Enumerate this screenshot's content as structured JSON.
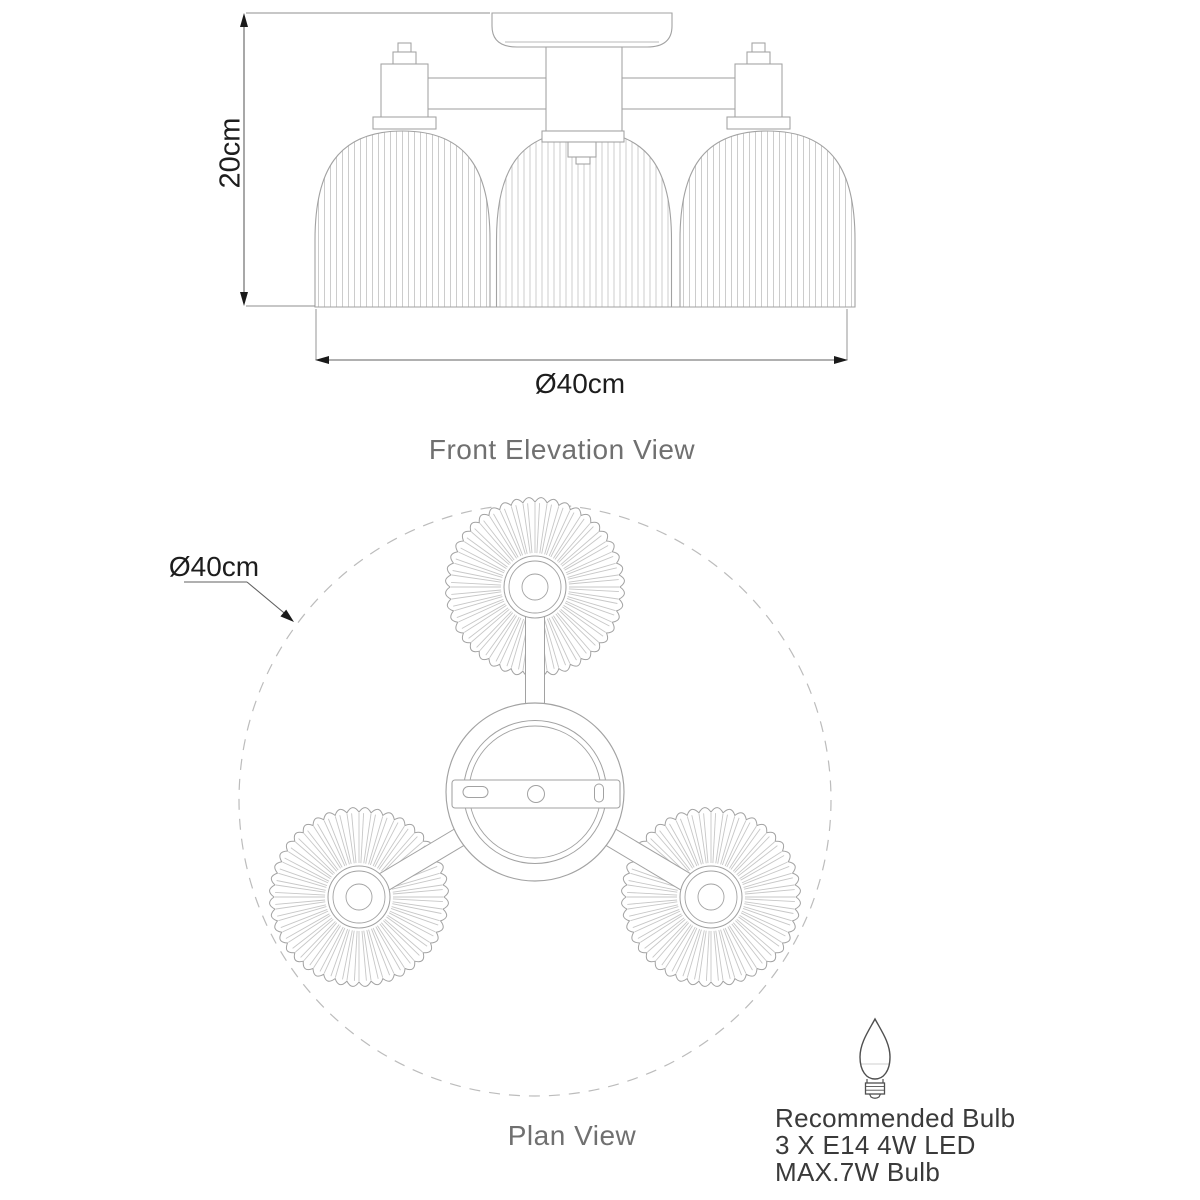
{
  "front_elevation": {
    "title": "Front Elevation View",
    "height_label": "20cm",
    "width_label": "Ø40cm"
  },
  "plan_view": {
    "title": "Plan View",
    "diameter_label": "Ø40cm"
  },
  "bulb_recommendation": {
    "heading": "Recommended Bulb",
    "spec_line": "3 X E14 4W LED",
    "max_line": "MAX.7W Bulb"
  },
  "colors": {
    "background": "#ffffff",
    "drawing_line": "#a2a2a2",
    "rib_line": "#c7c7c7",
    "dashed_line": "#bcbcbc",
    "dimension_line": "#606060",
    "extension_line": "#8f8f8f",
    "arrow": "#1a1a1a",
    "icon_line": "#4f4f4f"
  }
}
